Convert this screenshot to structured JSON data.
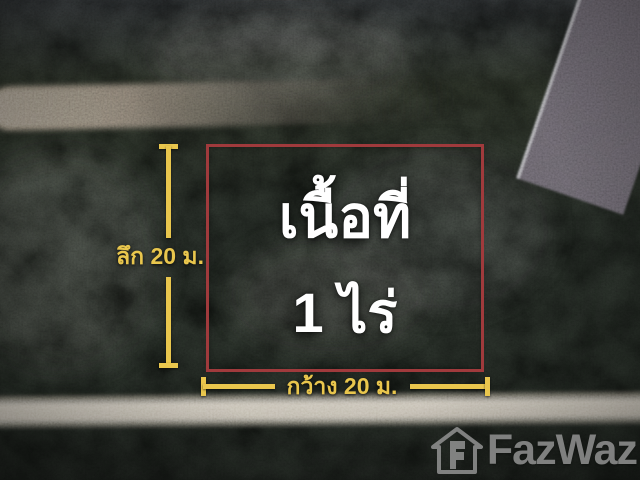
{
  "overlay": {
    "area_label": {
      "line1": "เนื้อที่",
      "line2": "1 ไร่"
    },
    "depth_label": "ลึก 20 ม.",
    "width_label": "กว้าง 20 ม."
  },
  "watermark": {
    "brand": "FazWaz"
  },
  "colors": {
    "plot_outline": "#a03a3c",
    "dimension_yellow": "#e9c64d",
    "area_text": "#ffffff",
    "watermark_gray": "#9d9d9d"
  }
}
